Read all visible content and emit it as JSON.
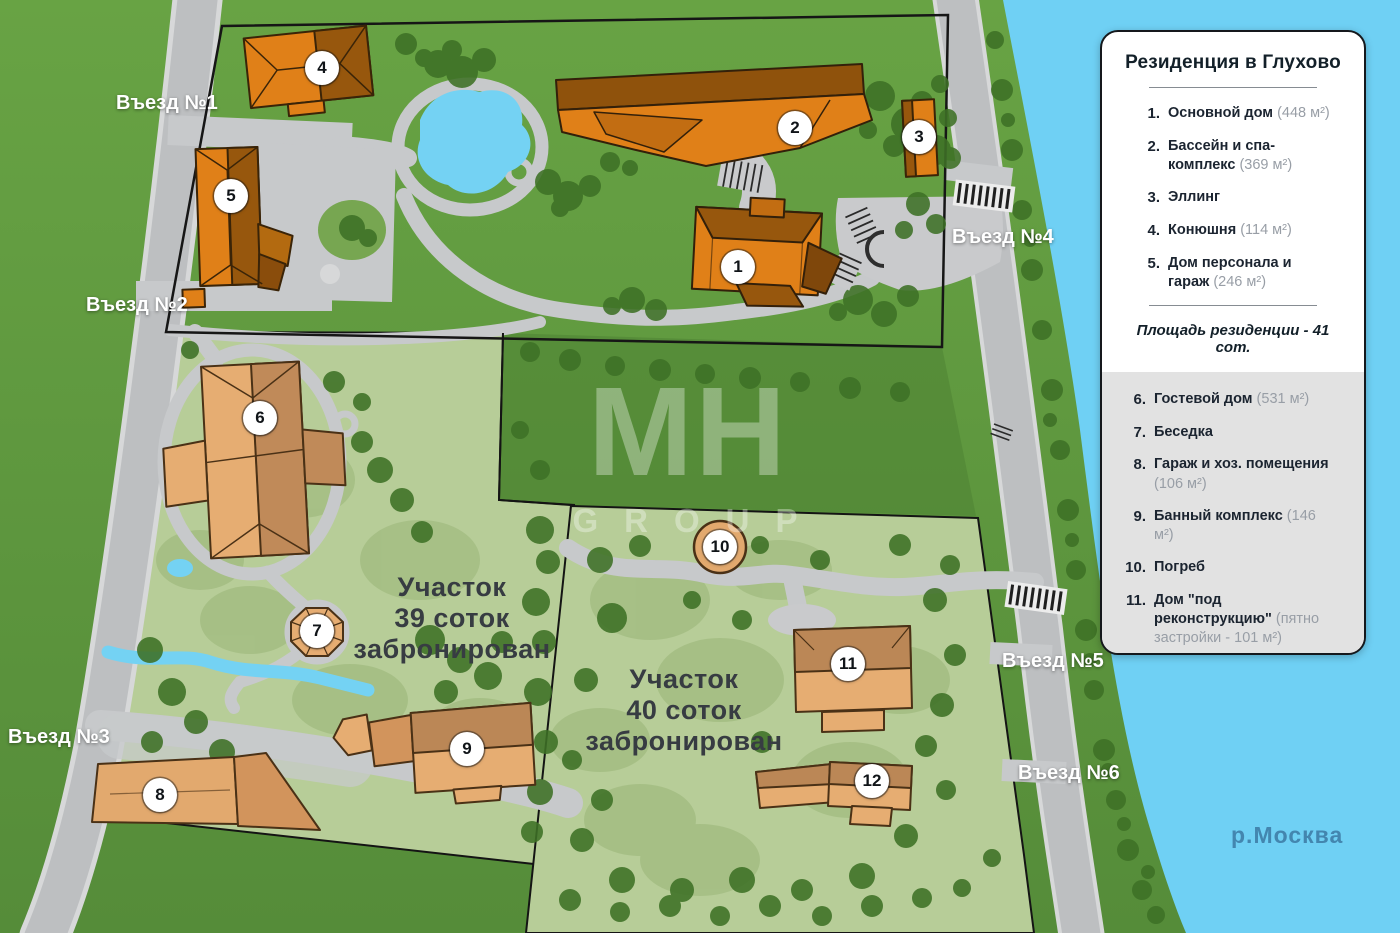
{
  "legend": {
    "title": "Резиденция в Глухово",
    "area_note": "Площадь резиденции - 41 сот.",
    "group1": [
      {
        "num": "1.",
        "name": "Основной дом",
        "area": "(448 м²)"
      },
      {
        "num": "2.",
        "name": "Бассейн и спа-комплекс",
        "area": "(369 м²)"
      },
      {
        "num": "3.",
        "name": "Эллинг",
        "area": ""
      },
      {
        "num": "4.",
        "name": "Конюшня",
        "area": "(114 м²)"
      },
      {
        "num": "5.",
        "name": "Дом персонала и гараж",
        "area": "(246 м²)"
      }
    ],
    "group2": [
      {
        "num": "6.",
        "name": "Гостевой дом",
        "area": "(531 м²)"
      },
      {
        "num": "7.",
        "name": "Беседка",
        "area": ""
      },
      {
        "num": "8.",
        "name": "Гараж и хоз. помещения",
        "area": "(106 м²)"
      },
      {
        "num": "9.",
        "name": "Банный комплекс",
        "area": "(146 м²)"
      },
      {
        "num": "10.",
        "name": "Погреб",
        "area": ""
      },
      {
        "num": "11.",
        "name": "Дом \"под реконструкцию\"",
        "area": "(пятно застройки - 101 м²)"
      },
      {
        "num": "12.",
        "name": "Дом \"под реконструкцию\"",
        "area": "(пятно застройки - 46 м²)"
      }
    ]
  },
  "map": {
    "entrances": [
      "Въезд №1",
      "Въезд №2",
      "Въезд №3",
      "Въезд №4",
      "Въезд №5",
      "Въезд №6"
    ],
    "parcel39": {
      "line1": "Участок",
      "line2": "39 соток",
      "line3": "забронирован"
    },
    "parcel40": {
      "line1": "Участок",
      "line2": "40 соток",
      "line3": "забронирован"
    },
    "river_label": "р.Москва",
    "watermark": {
      "line1": "MH",
      "line2": "GROUP"
    },
    "markers": [
      "1",
      "2",
      "3",
      "4",
      "5",
      "6",
      "7",
      "8",
      "9",
      "10",
      "11",
      "12"
    ]
  },
  "colors": {
    "building_orange": "#e08018",
    "building_orange_roof": "#97570d",
    "building_tan": "#e6ad72",
    "building_tan_roof": "#bb8756",
    "river": "#6fd0f4",
    "parcel_light": "#b7cd98",
    "road": "#bdbfc1",
    "outer_green": "#5f9a3f"
  }
}
